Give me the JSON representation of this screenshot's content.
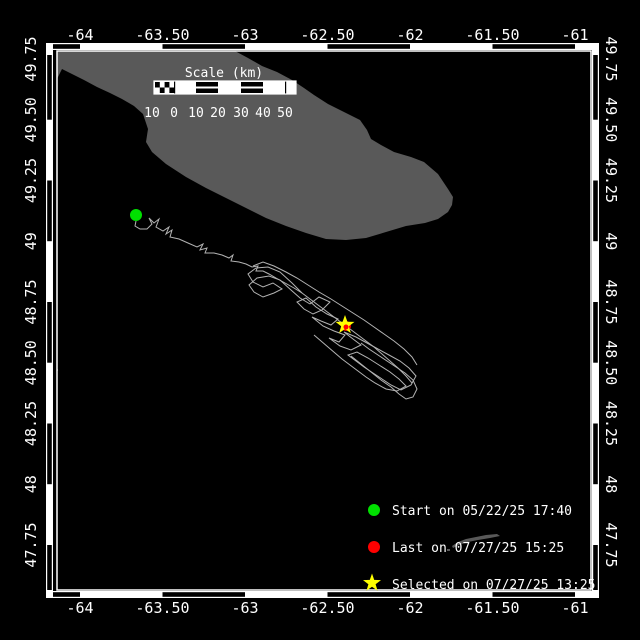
{
  "map": {
    "region": "Gulf of St. Lawrence / Anticosti Island",
    "axis": {
      "lon_ticks": [
        "-64",
        "-63.50",
        "-63",
        "-62.50",
        "-62",
        "-61.50",
        "-61"
      ],
      "lat_ticks": [
        "49.75",
        "49.50",
        "49.25",
        "49",
        "48.75",
        "48.50",
        "48.25",
        "48",
        "47.75"
      ],
      "lon_range": [
        -64.14,
        -60.9
      ],
      "lat_range": [
        47.57,
        49.78
      ]
    },
    "scale_bar": {
      "title": "Scale (km)",
      "labels": [
        "10",
        "0",
        "10",
        "20",
        "30",
        "40",
        "50"
      ]
    },
    "legend": [
      {
        "marker": "green-dot",
        "color": "#00e000",
        "label": "Start on 05/22/25 17:40"
      },
      {
        "marker": "red-dot",
        "color": "#ff0000",
        "label": "Last on 07/27/25 15:25"
      },
      {
        "marker": "yellow-star",
        "color": "#ffff00",
        "label": "Selected on 07/27/25 13:25"
      }
    ],
    "markers": {
      "start": {
        "x": 136,
        "y": 215,
        "lon": -63.66,
        "lat": 49.11
      },
      "last": {
        "x": 346,
        "y": 326,
        "lon": -62.39,
        "lat": 48.65
      },
      "selected": {
        "x": 345,
        "y": 325,
        "lon": -62.39,
        "lat": 48.66
      }
    },
    "colors": {
      "background": "#000000",
      "land": "#595959",
      "track": "#b3b3b3",
      "frame": "#ffffff",
      "start": "#00e000",
      "last": "#ff0000",
      "selected": "#ffff00"
    },
    "geometry": {
      "island": [
        [
          57,
          51
        ],
        [
          235,
          51
        ],
        [
          248,
          58
        ],
        [
          262,
          66
        ],
        [
          277,
          72
        ],
        [
          292,
          80
        ],
        [
          304,
          88
        ],
        [
          314,
          95
        ],
        [
          328,
          104
        ],
        [
          344,
          112
        ],
        [
          360,
          120
        ],
        [
          367,
          130
        ],
        [
          371,
          139
        ],
        [
          381,
          145
        ],
        [
          394,
          152
        ],
        [
          411,
          157
        ],
        [
          424,
          162
        ],
        [
          438,
          174
        ],
        [
          448,
          189
        ],
        [
          453,
          197
        ],
        [
          452,
          205
        ],
        [
          448,
          212
        ],
        [
          438,
          219
        ],
        [
          425,
          223
        ],
        [
          406,
          226
        ],
        [
          386,
          232
        ],
        [
          366,
          238
        ],
        [
          346,
          240
        ],
        [
          326,
          239
        ],
        [
          306,
          233
        ],
        [
          286,
          226
        ],
        [
          266,
          218
        ],
        [
          246,
          208
        ],
        [
          226,
          198
        ],
        [
          206,
          188
        ],
        [
          186,
          177
        ],
        [
          166,
          164
        ],
        [
          152,
          152
        ],
        [
          146,
          142
        ],
        [
          148,
          129
        ],
        [
          143,
          114
        ],
        [
          134,
          106
        ],
        [
          122,
          99
        ],
        [
          110,
          93
        ],
        [
          97,
          87
        ],
        [
          84,
          80
        ],
        [
          72,
          74
        ],
        [
          62,
          69
        ],
        [
          57,
          79
        ]
      ],
      "sliver": [
        [
          452,
          546
        ],
        [
          458,
          542
        ],
        [
          466,
          539
        ],
        [
          476,
          537
        ],
        [
          486,
          535
        ],
        [
          497,
          534
        ],
        [
          500,
          536
        ],
        [
          490,
          538
        ],
        [
          478,
          540
        ],
        [
          468,
          542
        ],
        [
          459,
          545
        ],
        [
          453,
          548
        ]
      ],
      "specks": [
        [
          51,
          304
        ],
        [
          53,
          340
        ],
        [
          55,
          369
        ],
        [
          447,
          549
        ]
      ]
    },
    "track": {
      "strands": [
        [
          [
            136,
            221
          ],
          [
            135,
            226
          ],
          [
            140,
            229
          ],
          [
            147,
            229
          ],
          [
            152,
            224
          ],
          [
            149,
            218
          ],
          [
            154,
            223
          ],
          [
            159,
            219
          ],
          [
            156,
            227
          ],
          [
            163,
            231
          ],
          [
            169,
            227
          ],
          [
            166,
            234
          ],
          [
            172,
            230
          ],
          [
            170,
            237
          ],
          [
            179,
            239
          ],
          [
            188,
            243
          ],
          [
            197,
            247
          ],
          [
            203,
            244
          ],
          [
            200,
            250
          ],
          [
            207,
            248
          ],
          [
            205,
            253
          ],
          [
            214,
            253
          ],
          [
            222,
            255
          ],
          [
            229,
            258
          ],
          [
            233,
            255
          ],
          [
            231,
            261
          ],
          [
            239,
            262
          ],
          [
            246,
            264
          ],
          [
            252,
            267
          ],
          [
            258,
            266
          ],
          [
            256,
            271
          ],
          [
            263,
            271
          ],
          [
            269,
            274
          ],
          [
            276,
            278
          ]
        ],
        [
          [
            276,
            278
          ],
          [
            285,
            283
          ],
          [
            294,
            288
          ],
          [
            302,
            293
          ],
          [
            310,
            299
          ],
          [
            318,
            305
          ],
          [
            326,
            311
          ],
          [
            334,
            317
          ],
          [
            342,
            323
          ],
          [
            350,
            329
          ],
          [
            358,
            335
          ],
          [
            366,
            341
          ],
          [
            374,
            347
          ],
          [
            382,
            354
          ],
          [
            390,
            361
          ],
          [
            398,
            368
          ],
          [
            406,
            376
          ],
          [
            412,
            383
          ]
        ],
        [
          [
            302,
            293
          ],
          [
            292,
            283
          ],
          [
            280,
            272
          ],
          [
            268,
            267
          ],
          [
            256,
            268
          ],
          [
            248,
            274
          ],
          [
            253,
            282
          ],
          [
            263,
            287
          ],
          [
            273,
            283
          ],
          [
            282,
            289
          ],
          [
            274,
            293
          ],
          [
            263,
            297
          ],
          [
            254,
            292
          ],
          [
            249,
            285
          ],
          [
            257,
            278
          ],
          [
            269,
            276
          ],
          [
            280,
            280
          ],
          [
            291,
            290
          ],
          [
            300,
            298
          ],
          [
            310,
            304
          ]
        ],
        [
          [
            310,
            304
          ],
          [
            319,
            297
          ],
          [
            330,
            302
          ],
          [
            322,
            310
          ],
          [
            313,
            314
          ],
          [
            304,
            309
          ],
          [
            297,
            302
          ],
          [
            306,
            298
          ],
          [
            316,
            307
          ],
          [
            327,
            314
          ],
          [
            338,
            319
          ],
          [
            331,
            325
          ],
          [
            321,
            321
          ],
          [
            312,
            317
          ],
          [
            323,
            326
          ],
          [
            334,
            331
          ],
          [
            345,
            335
          ],
          [
            339,
            342
          ],
          [
            329,
            338
          ],
          [
            340,
            346
          ],
          [
            351,
            350
          ],
          [
            361,
            345
          ],
          [
            353,
            339
          ],
          [
            344,
            332
          ],
          [
            356,
            337
          ],
          [
            367,
            343
          ],
          [
            378,
            349
          ]
        ],
        [
          [
            378,
            349
          ],
          [
            389,
            355
          ],
          [
            400,
            361
          ],
          [
            409,
            368
          ],
          [
            416,
            376
          ],
          [
            411,
            385
          ],
          [
            401,
            390
          ],
          [
            391,
            385
          ],
          [
            382,
            379
          ],
          [
            373,
            373
          ],
          [
            364,
            367
          ],
          [
            356,
            361
          ],
          [
            348,
            355
          ],
          [
            357,
            352
          ],
          [
            368,
            358
          ],
          [
            379,
            365
          ],
          [
            390,
            372
          ],
          [
            399,
            379
          ],
          [
            406,
            386
          ],
          [
            397,
            391
          ],
          [
            386,
            389
          ],
          [
            375,
            383
          ],
          [
            366,
            377
          ],
          [
            358,
            371
          ],
          [
            350,
            365
          ],
          [
            342,
            359
          ],
          [
            335,
            353
          ],
          [
            328,
            347
          ],
          [
            321,
            341
          ],
          [
            314,
            335
          ]
        ],
        [
          [
            351,
            356
          ],
          [
            361,
            364
          ],
          [
            371,
            372
          ],
          [
            381,
            380
          ],
          [
            391,
            387
          ],
          [
            399,
            394
          ],
          [
            406,
            399
          ],
          [
            413,
            397
          ],
          [
            417,
            389
          ],
          [
            413,
            380
          ],
          [
            405,
            373
          ],
          [
            396,
            367
          ],
          [
            387,
            361
          ],
          [
            378,
            355
          ],
          [
            369,
            349
          ],
          [
            361,
            343
          ]
        ],
        [
          [
            253,
            266
          ],
          [
            263,
            262
          ],
          [
            274,
            266
          ],
          [
            286,
            272
          ],
          [
            297,
            278
          ],
          [
            308,
            285
          ],
          [
            319,
            292
          ],
          [
            331,
            299
          ],
          [
            342,
            306
          ],
          [
            353,
            313
          ],
          [
            364,
            320
          ],
          [
            374,
            327
          ],
          [
            384,
            334
          ],
          [
            394,
            341
          ],
          [
            404,
            349
          ],
          [
            412,
            357
          ],
          [
            417,
            365
          ]
        ]
      ]
    }
  }
}
